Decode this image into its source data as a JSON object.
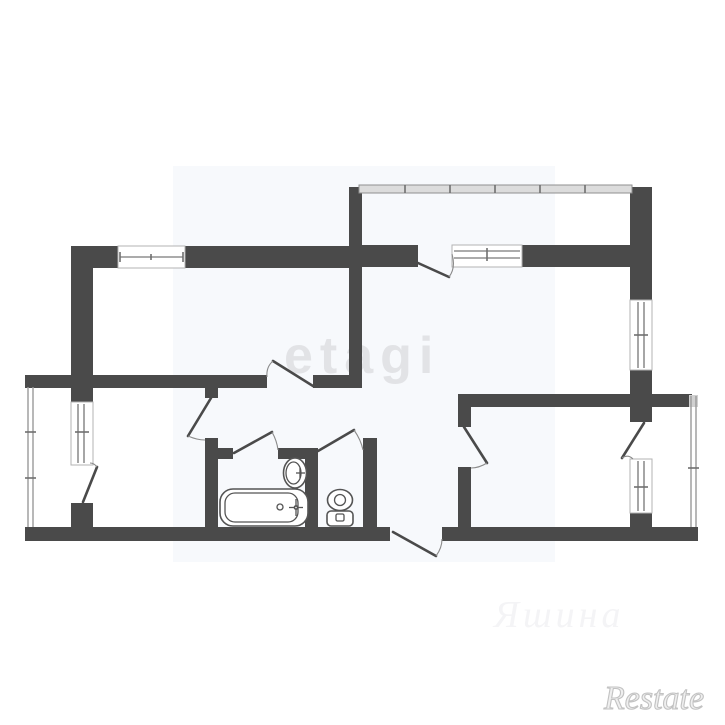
{
  "watermarks": {
    "center": {
      "text": "etagi",
      "color": "#e2e3e6"
    },
    "script": {
      "text": "Яшина",
      "color": "#f4f4f6"
    },
    "corner": {
      "text": "Restate",
      "color": "#c2c2c2"
    }
  },
  "plan": {
    "wall_color": "#4a4a4a",
    "line_color": "#8f8f8f",
    "background": "#ffffff",
    "photo_tint": "#f7f9fc",
    "windows": 5,
    "doors": 9,
    "balconies": 3,
    "fixtures": [
      "bathtub",
      "sink",
      "toilet"
    ]
  }
}
